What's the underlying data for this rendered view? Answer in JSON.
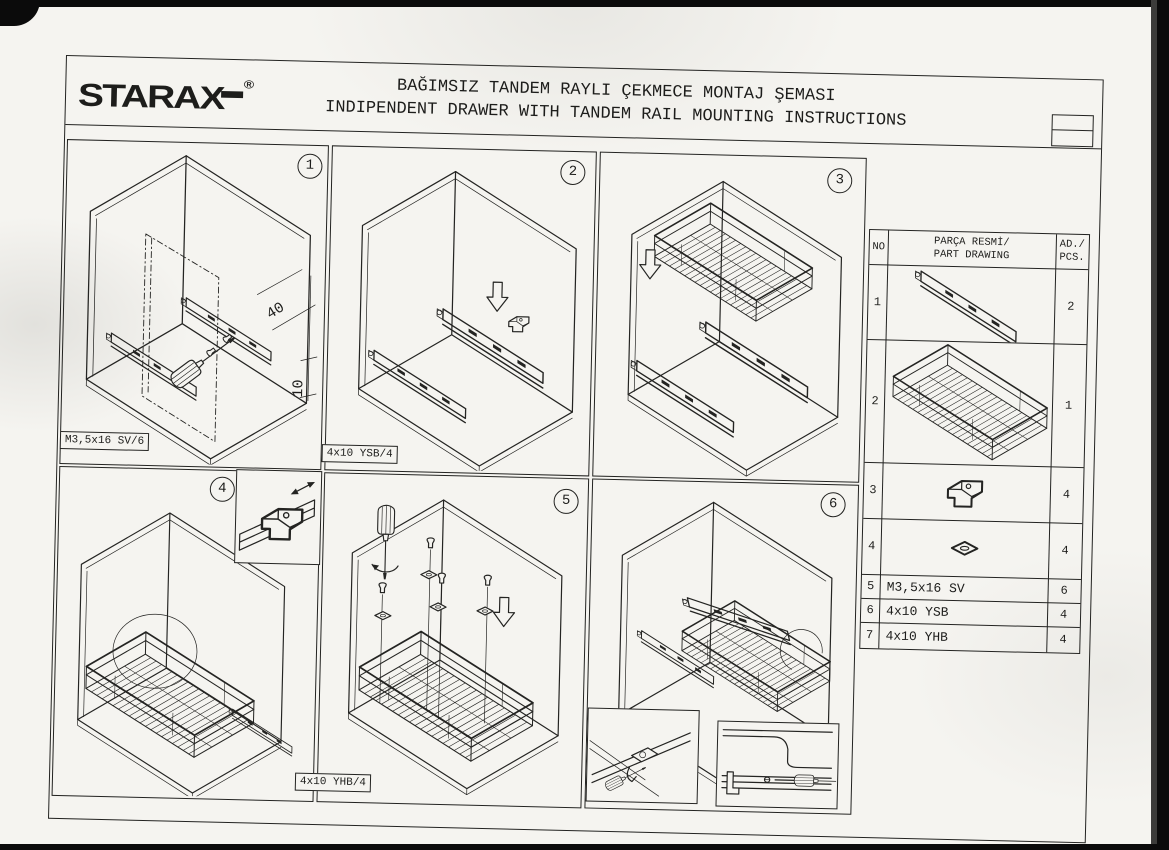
{
  "header": {
    "brand": "STARAX",
    "registered_mark": "®",
    "title_line1": "BAĞIMSIZ TANDEM RAYLI ÇEKMECE MONTAJ ŞEMASI",
    "title_line2": "INDIPENDENT DRAWER WITH TANDEM RAIL MOUNTING INSTRUCTIONS"
  },
  "panels": [
    {
      "number": "1",
      "label": "M3,5x16 SV/6",
      "dims": {
        "front_offset": "40",
        "bottom_offset": "10"
      }
    },
    {
      "number": "2",
      "label": "4x10 YSB/4"
    },
    {
      "number": "3",
      "label": ""
    },
    {
      "number": "4",
      "label": ""
    },
    {
      "number": "5",
      "label": "4x10 YHB/4"
    },
    {
      "number": "6",
      "label": ""
    }
  ],
  "parts_table": {
    "col_no": "NO",
    "col_drawing_line1": "PARÇA RESMİ/",
    "col_drawing_line2": "PART DRAWING",
    "col_qty_line1": "AD./",
    "col_qty_line2": "PCS.",
    "rows": [
      {
        "no": "1",
        "drawing": "tandem-rail-drawing",
        "text": "",
        "qty": "2"
      },
      {
        "no": "2",
        "drawing": "wire-basket-drawing",
        "text": "",
        "qty": "1"
      },
      {
        "no": "3",
        "drawing": "mounting-bracket-drawing",
        "text": "",
        "qty": "4"
      },
      {
        "no": "4",
        "drawing": "nut-washer-drawing",
        "text": "",
        "qty": "4"
      },
      {
        "no": "5",
        "drawing": "",
        "text": "M3,5x16 SV",
        "qty": "6"
      },
      {
        "no": "6",
        "drawing": "",
        "text": "4x10 YSB",
        "qty": "4"
      },
      {
        "no": "7",
        "drawing": "",
        "text": "4x10 YHB",
        "qty": "4"
      }
    ]
  },
  "colors": {
    "ink": "#1d1d1b",
    "paper": "#f5f4f0",
    "scan_background": "#0b0b0b"
  }
}
